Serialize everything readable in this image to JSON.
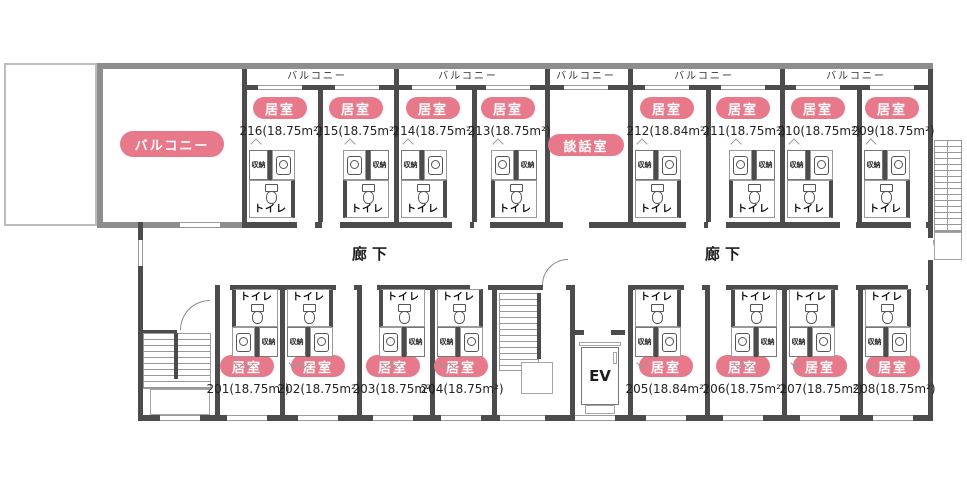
{
  "colors": {
    "accent_pink": "#e8798b",
    "wall_dark": "#4c4c4c",
    "wall_gray": "#8d8d8d",
    "outline_light": "#bdbdbd"
  },
  "labels": {
    "room_badge": "居室",
    "lounge": "談話室",
    "balcony": "バルコニー",
    "corridor": "廊下",
    "toilet": "トイレ",
    "storage": "収納",
    "elevator": "EV"
  },
  "rooms_top": [
    {
      "label": "216(18.75m²)"
    },
    {
      "label": "215(18.75m²)"
    },
    {
      "label": "214(18.75m²)"
    },
    {
      "label": "213(18.75m²)"
    },
    {
      "label": "212(18.84m²)"
    },
    {
      "label": "211(18.75m²)"
    },
    {
      "label": "210(18.75m²)"
    },
    {
      "label": "209(18.75m²)"
    }
  ],
  "rooms_bottom": [
    {
      "label": "201(18.75m²)"
    },
    {
      "label": "202(18.75m²)"
    },
    {
      "label": "203(18.75m²)"
    },
    {
      "label": "204(18.75m²)"
    },
    {
      "label": "205(18.84m²)"
    },
    {
      "label": "206(18.75m²)"
    },
    {
      "label": "207(18.75m²)"
    },
    {
      "label": "208(18.75m²)"
    }
  ]
}
